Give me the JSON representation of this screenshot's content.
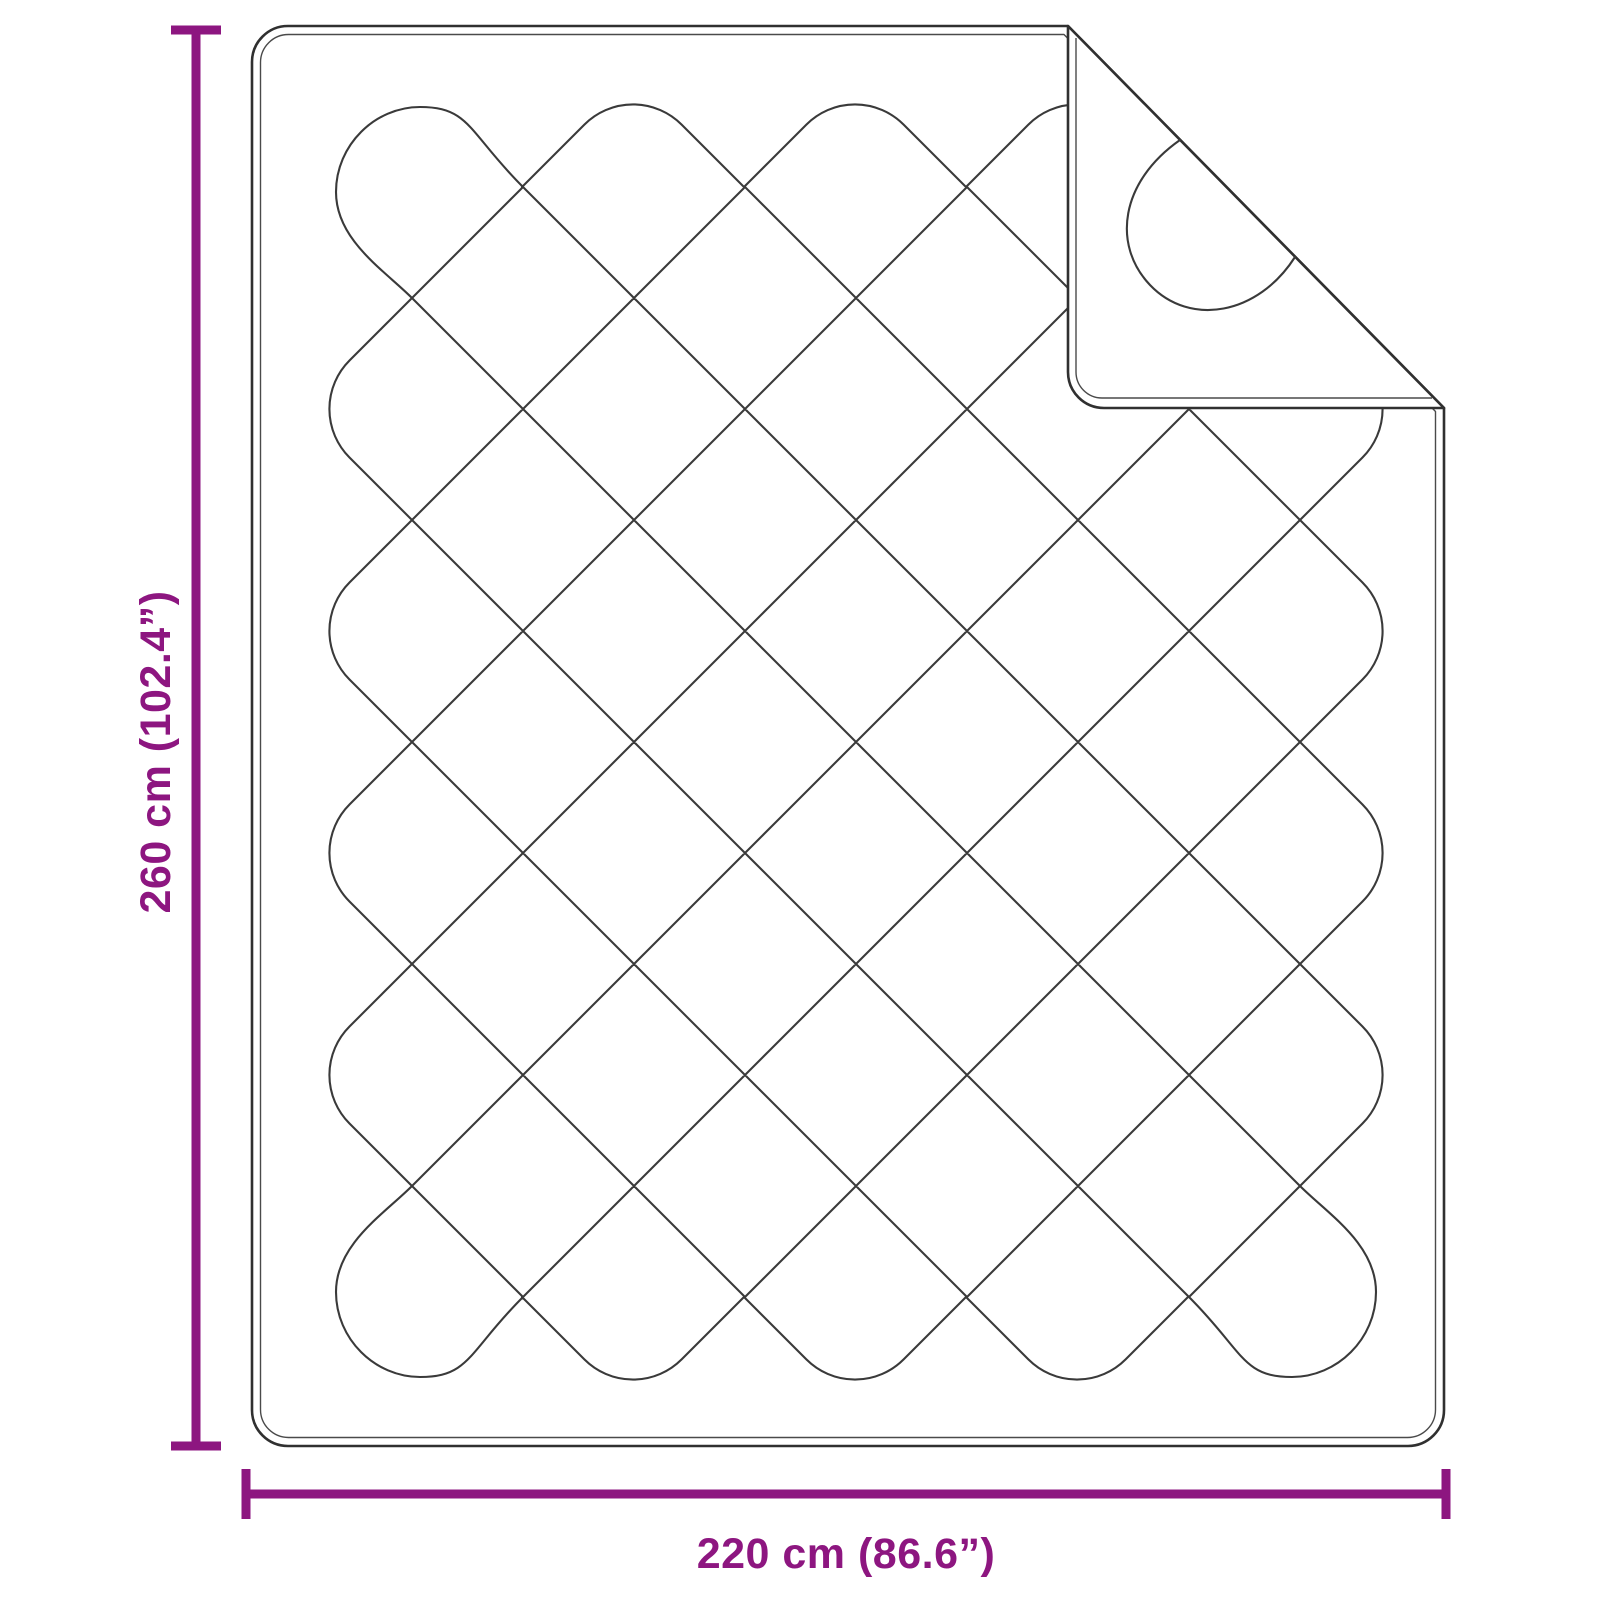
{
  "diagram": {
    "type": "product-dimension-diagram",
    "subject": "quilted-blanket-with-folded-corner"
  },
  "dimensions": {
    "height_label": "260 cm (102.4”)",
    "width_label": "220 cm (86.6”)"
  },
  "colors": {
    "accent": "#8D1680",
    "outline": "#303030",
    "outline_inner": "#4A4A4A",
    "pattern_line": "#3A3A3A"
  }
}
